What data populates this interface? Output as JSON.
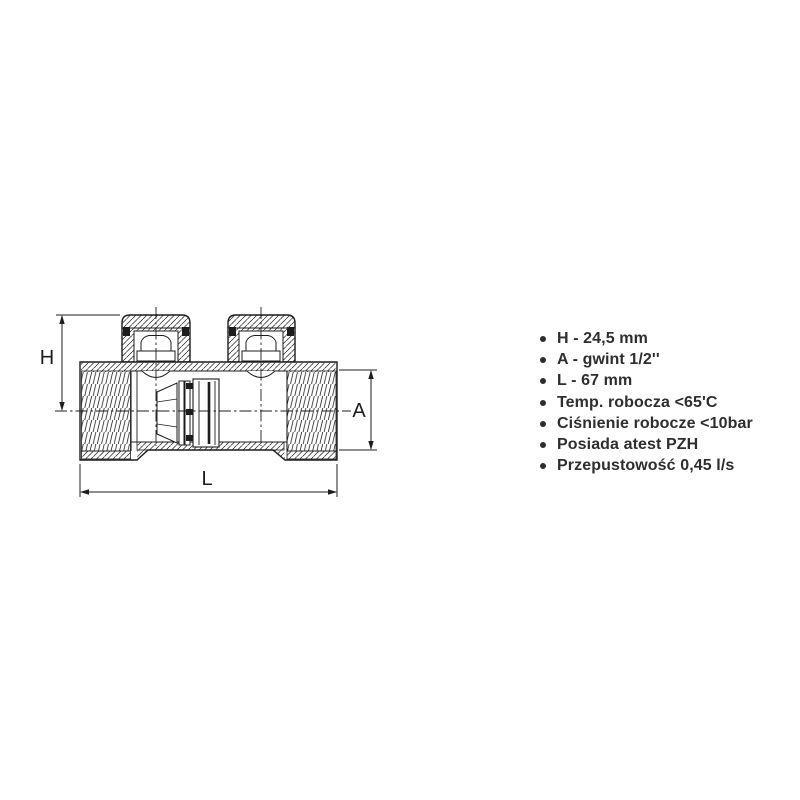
{
  "canvas": {
    "width": 800,
    "height": 800,
    "background": "#ffffff"
  },
  "drawing": {
    "type": "valve-cross-section-technical-drawing",
    "line_color": "#1d1d1d",
    "labels": {
      "height": "H",
      "thread_size": "A",
      "length": "L"
    }
  },
  "specs": {
    "bullet_color": "#2e2e2e",
    "text_color": "#2e2e2e",
    "items": [
      "H - 24,5 mm",
      "A - gwint 1/2''",
      "L - 67 mm",
      "Temp. robocza <65'C",
      "Ciśnienie robocze <10bar",
      "Posiada atest PZH",
      "Przepustowość 0,45 l/s"
    ]
  }
}
